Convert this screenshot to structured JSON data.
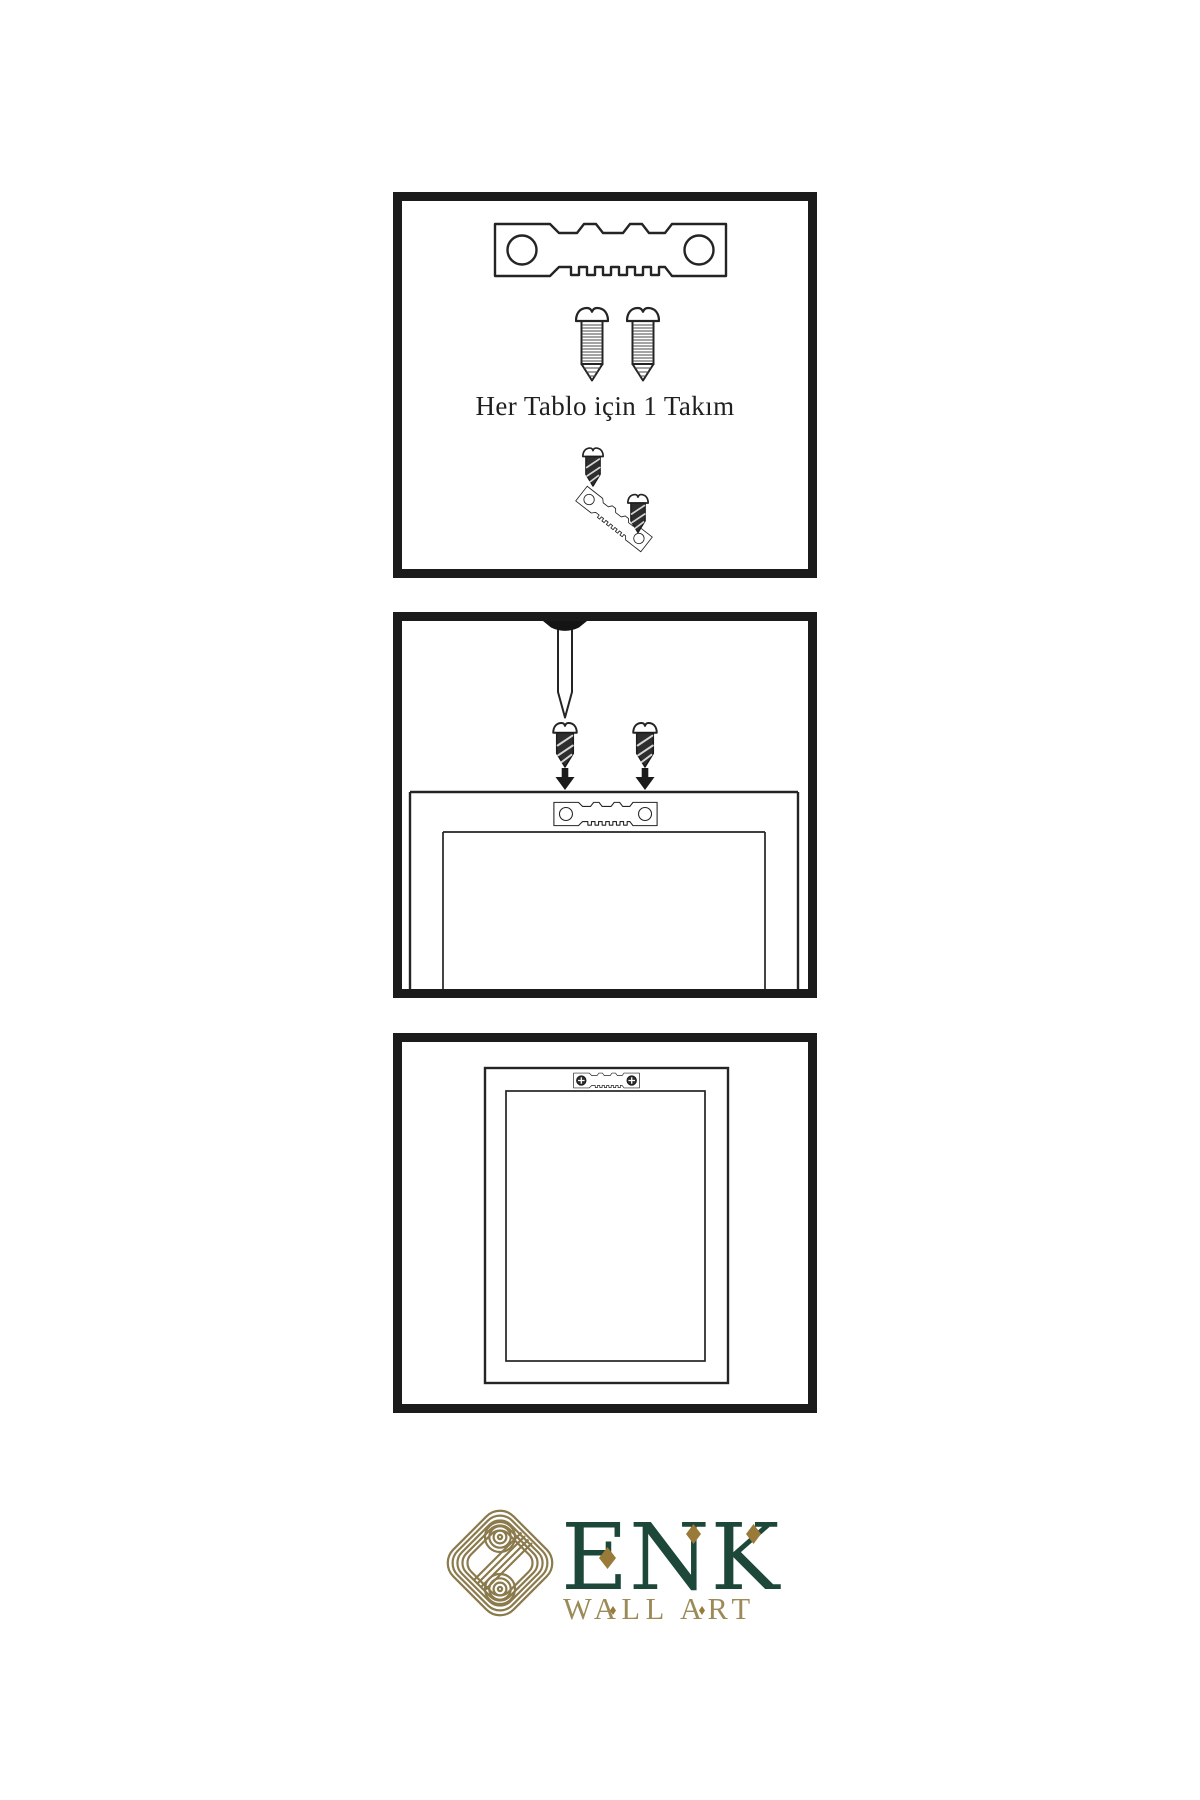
{
  "page": {
    "background": "#ffffff"
  },
  "instructions": {
    "step1": {
      "name": "hanging-kit-contents",
      "caption": "Her Tablo için 1 Takım",
      "icons": [
        "sawtooth-hanger-icon",
        "screw-icon",
        "screw-icon",
        "small-screw-icon",
        "angled-sawtooth-hanger-icon",
        "small-screw-icon"
      ]
    },
    "step2": {
      "name": "attach-hanger-to-frame-back",
      "icons": [
        "nail-icon",
        "dark-screw-icon",
        "dark-screw-icon",
        "down-arrow-icon",
        "down-arrow-icon",
        "frame-back-icon",
        "sawtooth-hanger-icon"
      ]
    },
    "step3": {
      "name": "frame-hung-on-wall",
      "icons": [
        "hanging-frame-icon",
        "sawtooth-hanger-with-screws-icon"
      ]
    }
  },
  "brand": {
    "logo": "knot-icon",
    "name": "ENK",
    "subtitle": "WALL ART",
    "colors": {
      "green": "#1c4739",
      "gold": "#9c8b59",
      "diamond_gold": "#9a7a38",
      "knot_gold": "#8a7a4c",
      "line_ink": "#1b1b1b",
      "background": "#ffffff"
    }
  }
}
